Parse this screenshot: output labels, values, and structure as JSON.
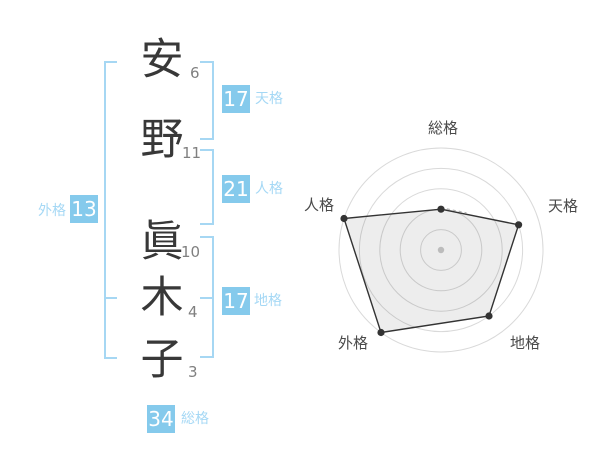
{
  "name_diagram": {
    "characters": [
      {
        "char": "安",
        "strokes": "6"
      },
      {
        "char": "野",
        "strokes": "11"
      },
      {
        "char": "眞",
        "strokes": "10"
      },
      {
        "char": "木",
        "strokes": "4"
      },
      {
        "char": "子",
        "strokes": "3"
      }
    ],
    "badges": {
      "tenkaku": {
        "value": "17",
        "label": "天格"
      },
      "jinkaku": {
        "value": "21",
        "label": "人格"
      },
      "chikaku": {
        "value": "17",
        "label": "地格"
      },
      "gaikaku": {
        "value": "13",
        "label": "外格"
      },
      "soukaku": {
        "value": "34",
        "label": "総格"
      }
    },
    "colors": {
      "badge_bg": "#85caec",
      "badge_text": "#ffffff",
      "label_text": "#a5d8f5",
      "bracket": "#a6d7f3",
      "char_text": "#383838",
      "stroke_text": "#808080"
    }
  },
  "chart_data": {
    "type": "radar",
    "title": "",
    "categories": [
      "総格",
      "天格",
      "地格",
      "外格",
      "人格"
    ],
    "values": [
      40,
      80,
      80,
      100,
      100
    ],
    "max": 100,
    "rings": 5,
    "grid": "concentric-circles",
    "legend": "none",
    "line_color": "#333333",
    "fill_color": "rgba(0,0,0,0.07)",
    "ring_color": "#d9d9d9",
    "dot_color": "#333333",
    "center_dot_color": "#bcbcbc",
    "label_color": "#4a4a4a"
  }
}
